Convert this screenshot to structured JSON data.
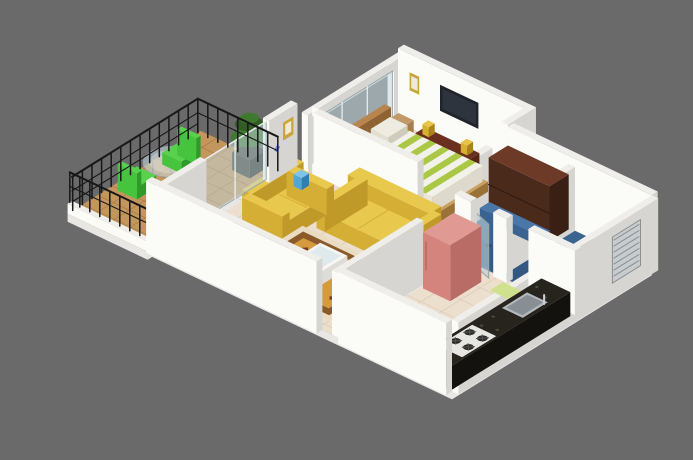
{
  "scene_title": "3D isometric floor-plan render of a one-bedroom apartment",
  "background": "#6a6a6a",
  "palette": {
    "wallTop": "#efeeeb",
    "wallFront": "#fbfbf8",
    "wallSide": "#d6d5d1",
    "slabSide": "#e9e7e3",
    "tileFloor": "#ecdfcd",
    "tileLine": "#d9cab3",
    "bedroomFloor": "#e9dbc8",
    "wood": "#c3965e",
    "woodLine": "#a87a45",
    "bathBlue": "#3a648f",
    "bathBlueLight": "#4a77a8",
    "bathBlueDark": "#2c4f76",
    "bedGreen": "#aac846",
    "bedWhite": "#f3f2ea",
    "pillow": "#eeece0",
    "headboard": "#b9854e",
    "frameWood": "#c9a05e",
    "sofaYellow": "#e9c84e",
    "sofaFront": "#d4ae35",
    "sofaSide": "#c09a28",
    "carpetBorder": "#e9dcc2",
    "carpetMid": "#8a5a2a",
    "carpetField": "#d69a3e",
    "carpetAccent": "#7a3c1e",
    "tableWhite": "#f6f6f4",
    "tableSide": "#dcdcd8",
    "granite": "#26241d",
    "graniteFront": "#1b1914",
    "graniteSide": "#14120e",
    "speckle": "#57523f",
    "sinkGray": "#b2b8bc",
    "sinkInner": "#878f94",
    "stoveWhite": "#e6e6e2",
    "burner": "#2b2b28",
    "fridgePink": "#d4837d",
    "fridgeTop": "#e09a93",
    "fridgeSide": "#b96b66",
    "wardrobeTop": "#6e3a28",
    "wardrobeFront": "#4a2a1a",
    "wardrobeSide": "#3a2014",
    "tvCab": "#6b2f1f",
    "tvCabFront": "#582515",
    "tvBlack": "#20242a",
    "tvShine": "#4a5460",
    "decorGold": "#d7b12e",
    "basinGreen": "#dfe8a6",
    "glass": "#c5dae0",
    "glassFrame": "#9aa6aa",
    "glassPost": "#e8ecec",
    "railBlack": "#181818",
    "plantGreen": "#3f7a30",
    "plantDark": "#2e5c22",
    "pot": "#3a3d35",
    "chairGreen": "#46c43e",
    "chairGreenDark": "#2f9a2a",
    "chairGreenTop": "#58d24c",
    "doorDark": "#3a3f44",
    "doorTop": "#4a4f54",
    "doorSide": "#2e3236",
    "matGreen": "#cfe08a",
    "jugBlue": "#4fa8d8",
    "lampBlue": "#6f8cd8",
    "frameGold": "#c9a63a",
    "frameInner": "#efe9da",
    "ledgeTan": "#c2996a",
    "ledgeSide": "#a87d4e",
    "vaseBlue": "#5a8fd0"
  },
  "rooms": [
    "bedroom",
    "attached-bathroom",
    "common-bathroom",
    "kitchen",
    "living-room",
    "balcony",
    "lobby"
  ],
  "objects": [
    "double-bed",
    "wall-tv",
    "tv-cabinet",
    "wardrobe",
    "window-seat",
    "wash-basin",
    "shower-glass-door",
    "vent-grille",
    "kitchen-counter",
    "sink",
    "gas-stove",
    "refrigerator",
    "two-seater-sofa",
    "three-seater-sofa",
    "area-rug",
    "coffee-table",
    "entrance-door",
    "water-jug",
    "balcony-table",
    "balcony-chair",
    "potted-plant",
    "balcony-railing",
    "glass-partition",
    "picture-frame",
    "wall-lamp",
    "bath-mat"
  ]
}
